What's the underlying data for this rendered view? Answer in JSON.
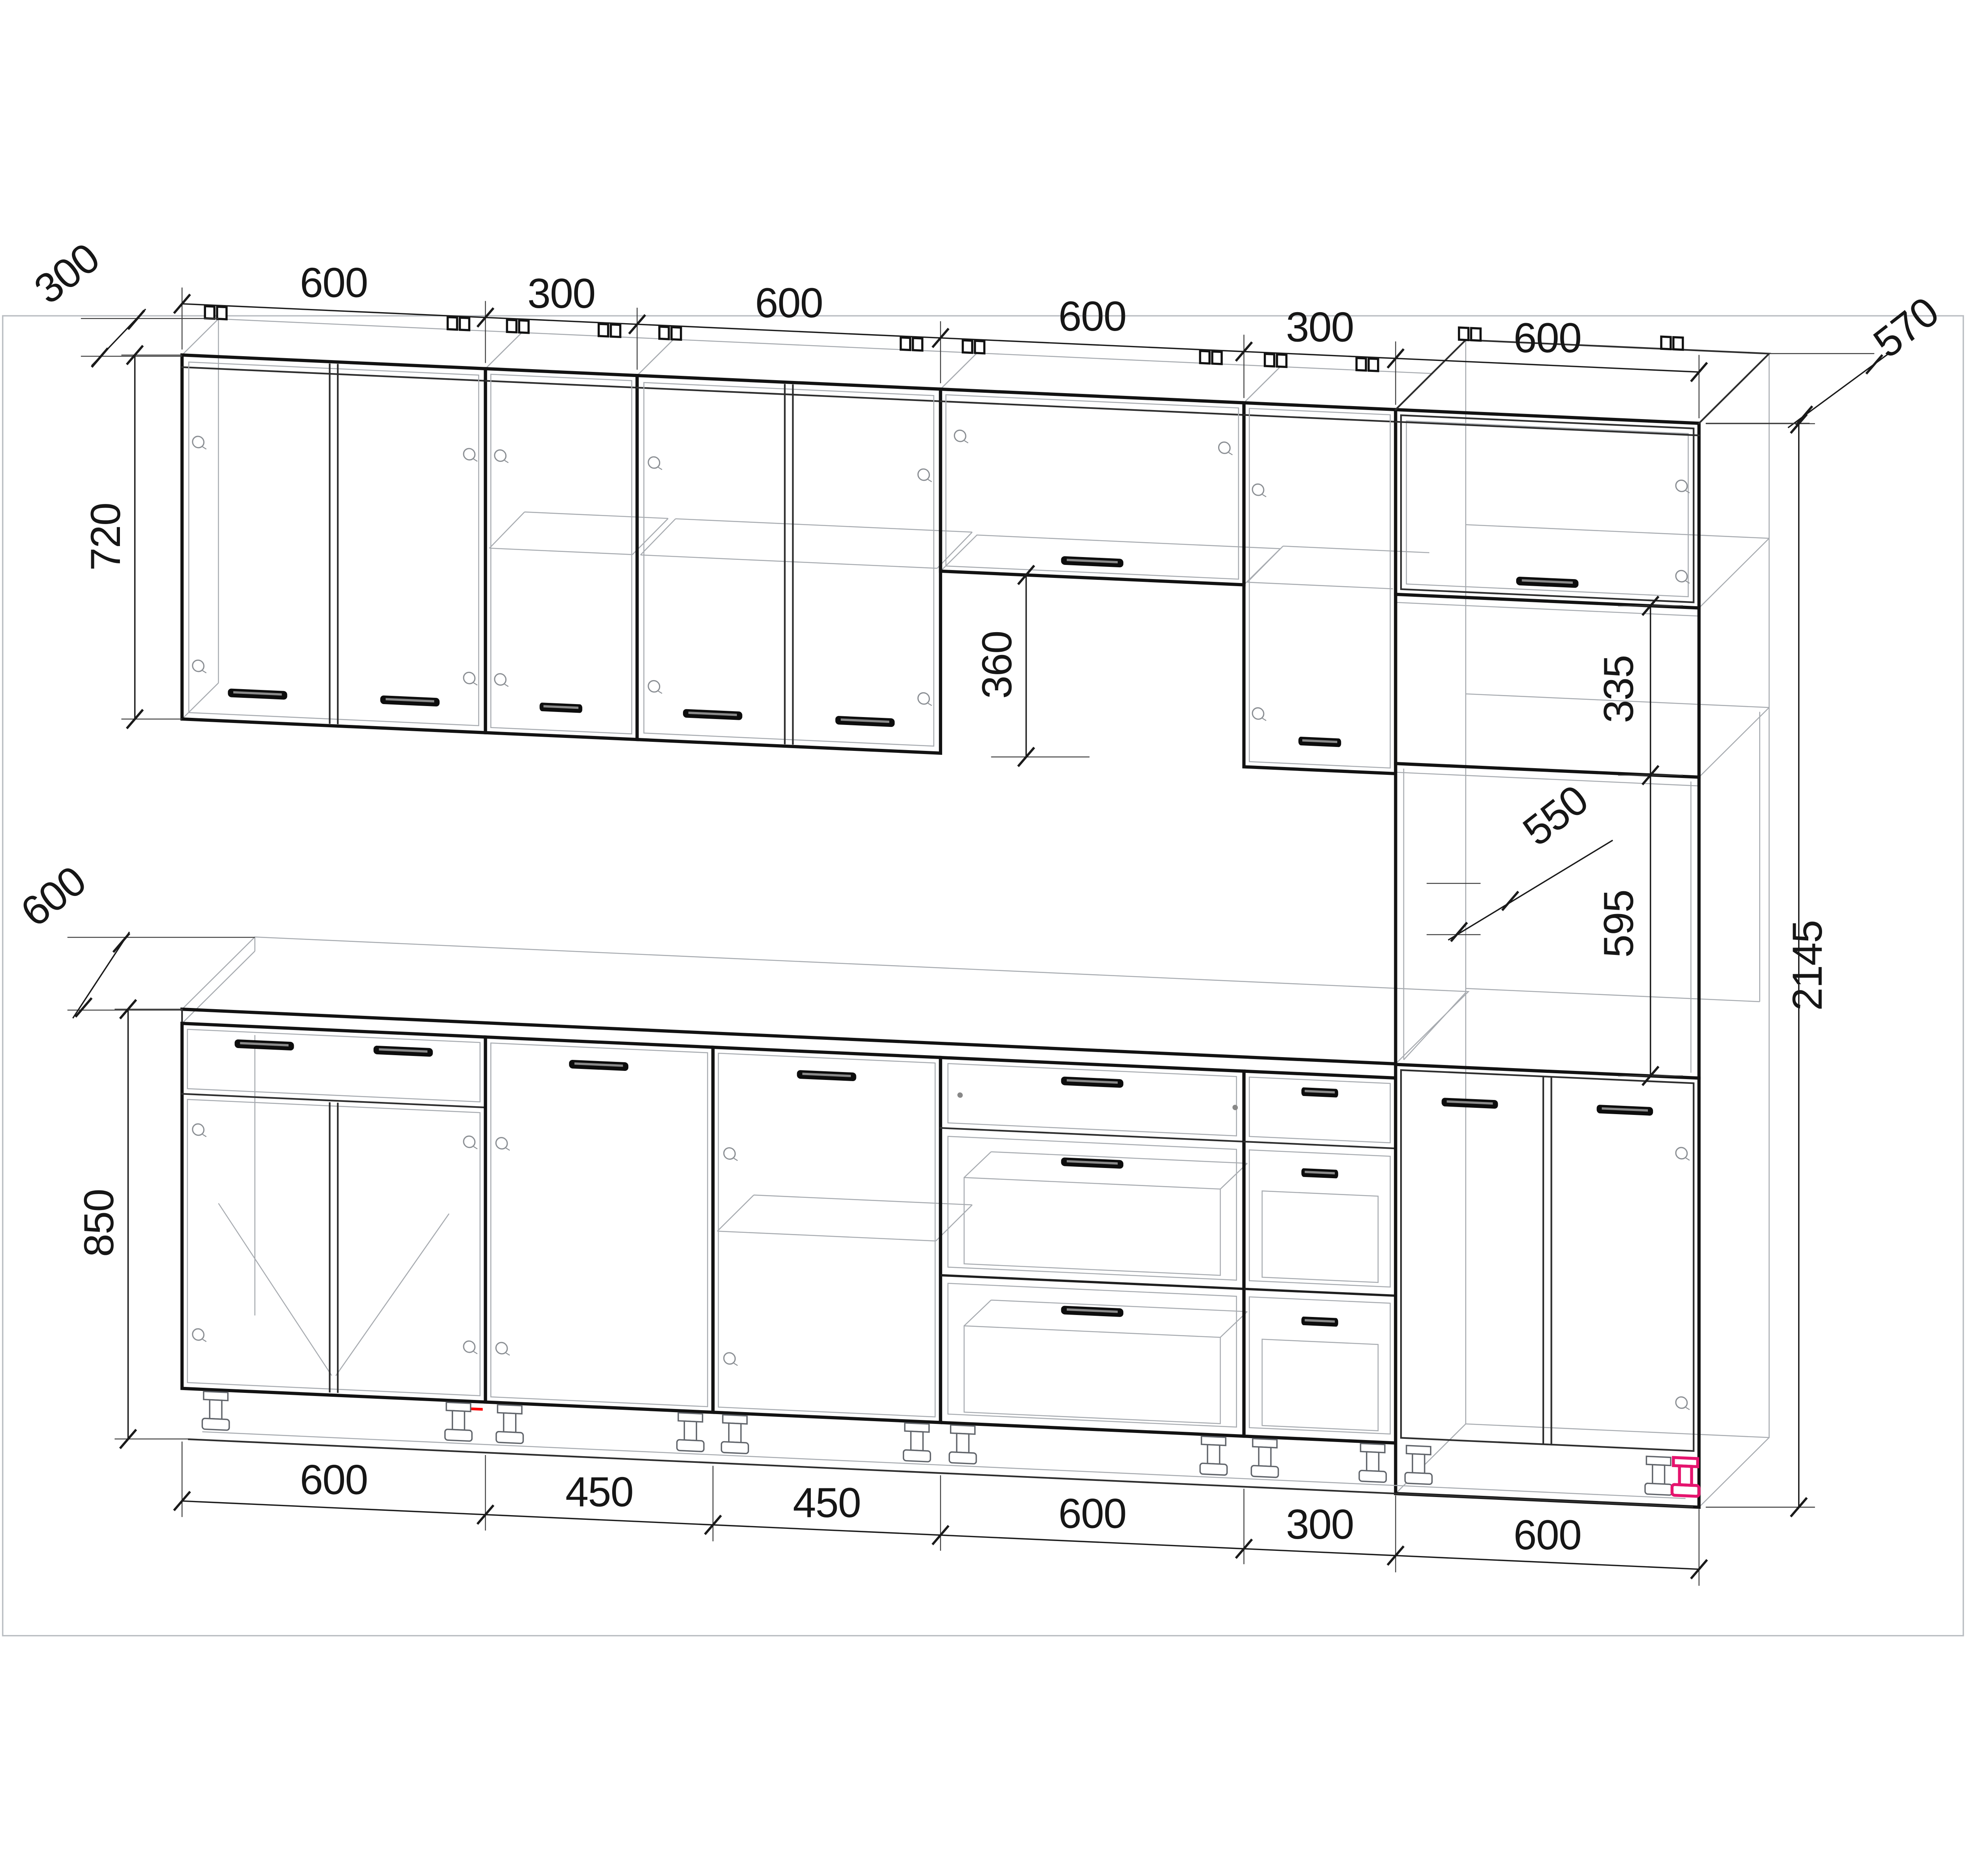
{
  "drawing": {
    "type": "kitchen-furniture-elevation",
    "projection": "oblique-perspective",
    "units": "mm",
    "colors": {
      "line": "#121212",
      "wireframe": "#a7abb0",
      "frame": "#b9bdc2",
      "highlight_leg": "#e5146e",
      "plinth_mark": "#ff0000",
      "text": "#161616",
      "background": "#ffffff"
    },
    "dims": {
      "top": [
        "600",
        "300",
        "600",
        "600",
        "300",
        "600"
      ],
      "bottom": [
        "600",
        "450",
        "450",
        "600",
        "300",
        "600"
      ],
      "left": {
        "wall_depth": "300",
        "wall_height": "720",
        "counter_depth": "600",
        "base_height": "850"
      },
      "middle": {
        "hood_gap": "360"
      },
      "right": {
        "tall_depth": "570",
        "shelf_gap": "335",
        "interior_depth": "550",
        "oven_niche": "595",
        "total_height": "2145"
      }
    },
    "wall_units": [
      {
        "width_mm": 600,
        "doors": 2,
        "height_mm": 720
      },
      {
        "width_mm": 300,
        "doors": 1,
        "height_mm": 720,
        "shelf": true
      },
      {
        "width_mm": 600,
        "doors": 2,
        "height_mm": 720,
        "shelf": true
      },
      {
        "width_mm": 600,
        "doors": 1,
        "height_mm": 360,
        "style": "flip-up"
      },
      {
        "width_mm": 300,
        "doors": 1,
        "height_mm": 720,
        "shelf": true
      },
      {
        "width_mm": 600,
        "part_of": "tall-column"
      }
    ],
    "base_units": [
      {
        "width_mm": 600,
        "drawer_front": true,
        "doors": 2
      },
      {
        "width_mm": 450,
        "doors": 1
      },
      {
        "width_mm": 450,
        "doors": 1,
        "shelf": true
      },
      {
        "width_mm": 600,
        "drawers": 3
      },
      {
        "width_mm": 300,
        "drawers": 3
      },
      {
        "width_mm": 600,
        "doors": 2,
        "part_of": "tall-column"
      }
    ],
    "tall_unit": {
      "width_mm": 600,
      "height_mm": 2145,
      "depth_mm": 570,
      "upper_shelf_gap_mm": 335,
      "interior_depth_mm": 550,
      "oven_niche_mm": 595
    }
  }
}
